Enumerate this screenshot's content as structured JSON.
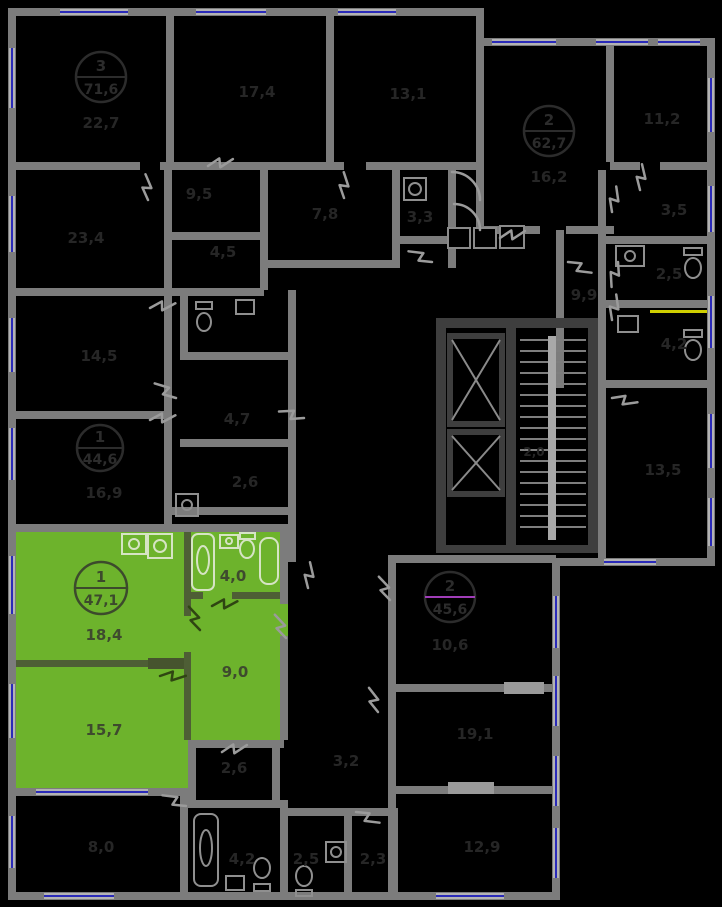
{
  "plan_title": "floor-plan",
  "colors": {
    "selected_fill": "#6db32c",
    "wall": "#7c7c7c",
    "core_wall": "#3e3e3e",
    "window_glass": "#2a2ab8",
    "duct_yellow": "#cfcf00",
    "badge_magenta": "#a03db8",
    "background": "#000000"
  },
  "apartments": {
    "selected": {
      "number": "1",
      "area": "47,1",
      "rooms": {
        "living": "18,4",
        "bedroom": "15,7",
        "hall": "9,0",
        "bathroom": "4,0"
      }
    },
    "top_left": {
      "number": "3",
      "area": "71,6"
    },
    "top_right": {
      "number": "2",
      "area": "62,7"
    },
    "left": {
      "number": "1",
      "area": "44,6"
    },
    "bottom": {
      "number": "2",
      "area": "45,6"
    }
  },
  "room_labels": {
    "r22_7": "22,7",
    "r17_4": "17,4",
    "r13_1": "13,1",
    "r16_2": "16,2",
    "r11_2": "11,2",
    "r3_5": "3,5",
    "r2_5a": "2,5",
    "r4_2a": "4,2",
    "r13_5": "13,5",
    "r9_9": "9,9",
    "r9_5": "9,5",
    "r4_5": "4,5",
    "r7_8": "7,8",
    "r3_3": "3,3",
    "r23_4": "23,4",
    "r14_5": "14,5",
    "r16_9": "16,9",
    "r4_7": "4,7",
    "r2_6a": "2,6",
    "r2_0": "2,0",
    "r10_6": "10,6",
    "r19_1": "19,1",
    "r12_9": "12,9",
    "r3_2": "3,2",
    "r2_6b": "2,6",
    "r8_0": "8,0",
    "r4_2b": "4,2",
    "r2_5b": "2,5",
    "r2_3": "2,3"
  },
  "icons": {
    "elevator": "elevator-shaft-x",
    "stairs": "stair-treads",
    "bathtub": "bathtub-outline",
    "toilet": "toilet-outline",
    "sink": "sink-outline",
    "washer": "washing-machine-outline",
    "heater": "water-heater-outline",
    "door": "door-swing-zigzag",
    "window": "window-glazing-line"
  }
}
